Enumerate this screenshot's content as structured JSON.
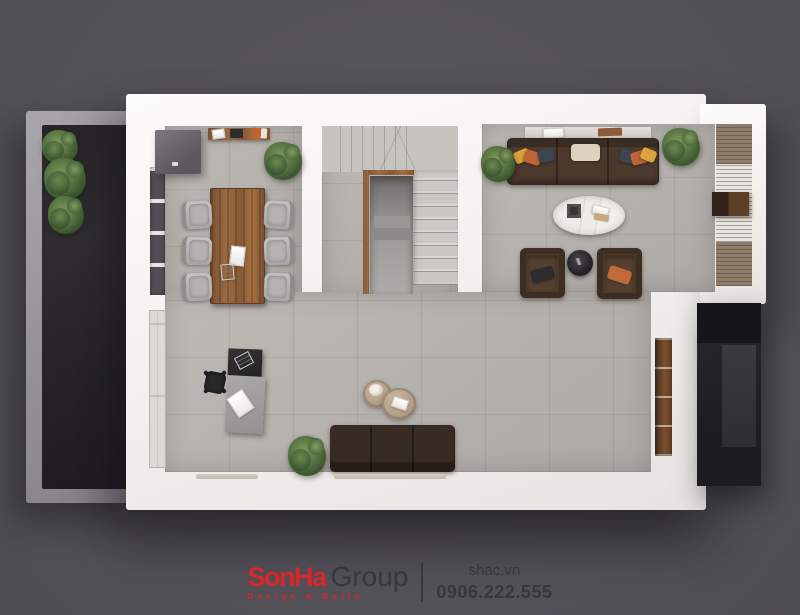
{
  "watermark": {
    "brand_red": "SonHa",
    "brand_dark": "Group",
    "tagline": "Design & Build",
    "website": "shac.vn",
    "phone": "0906.222.555"
  },
  "colors": {
    "background": "#56545b",
    "walls": "#f2f0ed",
    "floor_tile": "#b7b3af",
    "side_deck": "#262428",
    "wood": "#8a5c38",
    "sofa_brown": "#4a392c",
    "brand_red": "#d8262a",
    "watermark_text": "#38373d"
  },
  "scene": {
    "type": "3d-top-down-floor-plan-render",
    "areas": [
      "side yard deck",
      "dining area",
      "central staircase",
      "living room",
      "work corner"
    ],
    "furniture": [
      "storage cabinet",
      "console table",
      "wooden dining table",
      "six gray dining chairs",
      "L-shaped stairs with understair nook",
      "three-seat brown sofa with cushions",
      "oval marble coffee table",
      "two brown armchairs",
      "round black side table",
      "slatted tv feature wall",
      "wall bookshelf niche",
      "black-and-gray writing desk",
      "office chair",
      "tan nesting coffee tables",
      "three-seat bench sofa",
      "exterior dark stair block",
      "potted plants"
    ]
  }
}
